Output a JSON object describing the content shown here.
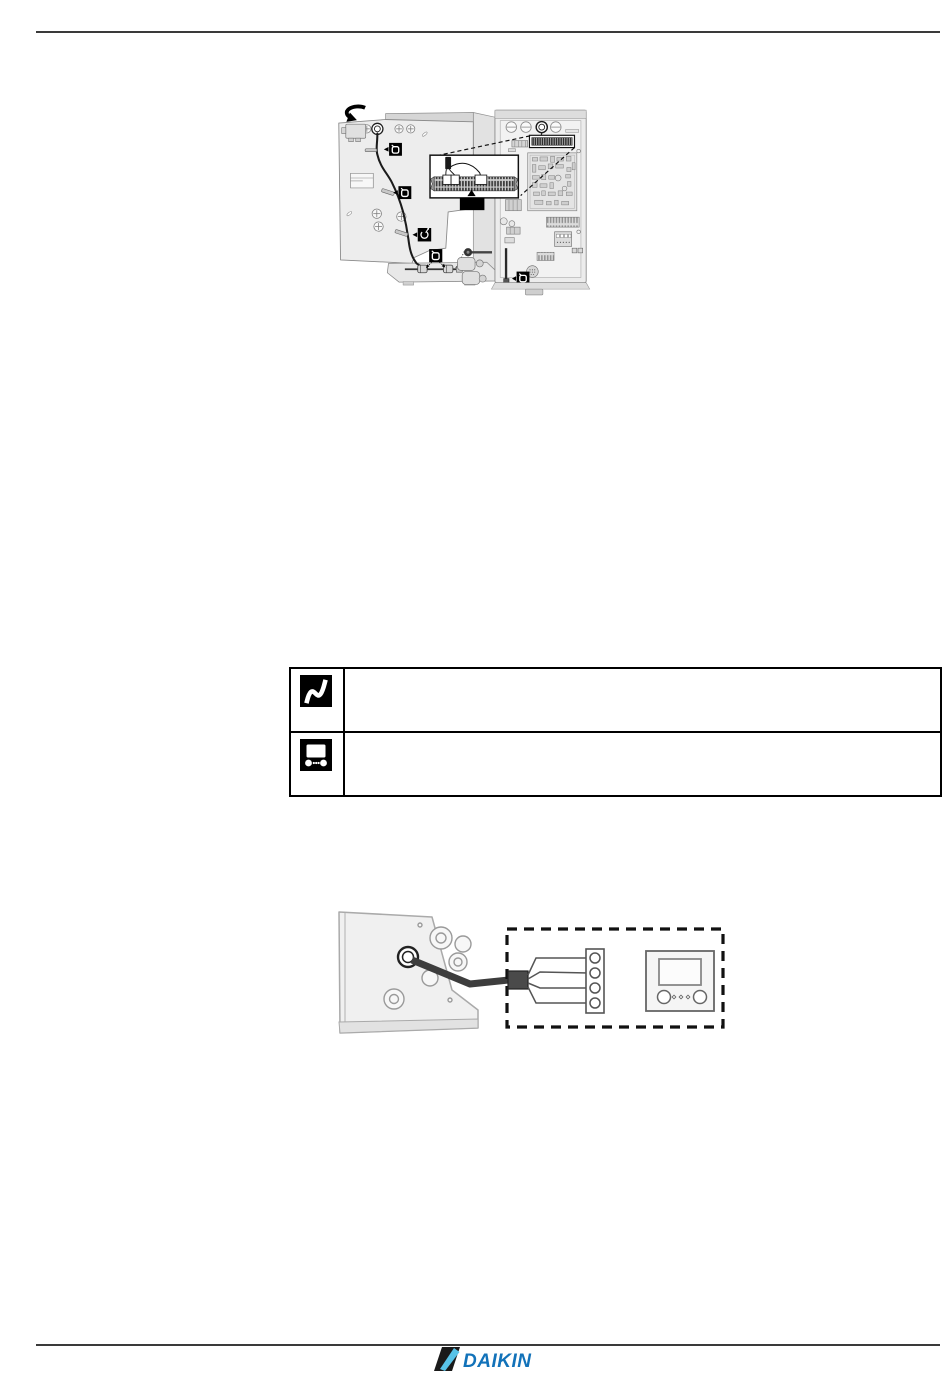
{
  "page": {
    "background_color": "#ffffff",
    "rule_color": "#3a3a3a"
  },
  "top_figure": {
    "icons": {
      "rotate_arrow": "rotate-clockwise-arrow-icon",
      "cable_clip_markers": [
        "cable-clip-loop-icon",
        "cable-clip-loop-icon",
        "cable-tie-icon",
        "cable-clip-loop-icon",
        "cable-clip-loop-icon"
      ],
      "detail_callout_label_text": ""
    },
    "colors": {
      "marker_background": "#000000",
      "marker_glyph": "#ffffff",
      "cable": "#1b1b1b",
      "line_art": "#8a8a8a",
      "panel_fill": "#ededed",
      "callout_label_fill": "#000000"
    }
  },
  "info_table": {
    "border_color": "#000000",
    "rows": [
      {
        "icon": "flexible-cable-icon",
        "text": ""
      },
      {
        "icon": "user-interface-icon",
        "text": ""
      }
    ]
  },
  "bottom_figure": {
    "icons": {
      "terminal_block": "4-terminal-strip-icon",
      "thermostat": "room-thermostat-icon"
    },
    "colors": {
      "dashed_border": "#111111",
      "cable": "#3d3d3d"
    }
  },
  "footer": {
    "logo_text": "DAIKIN",
    "logo_text_color": "#1272b9",
    "logo_mark_color": "#1a1a1a",
    "logo_swoosh_color": "#58c3e8"
  }
}
